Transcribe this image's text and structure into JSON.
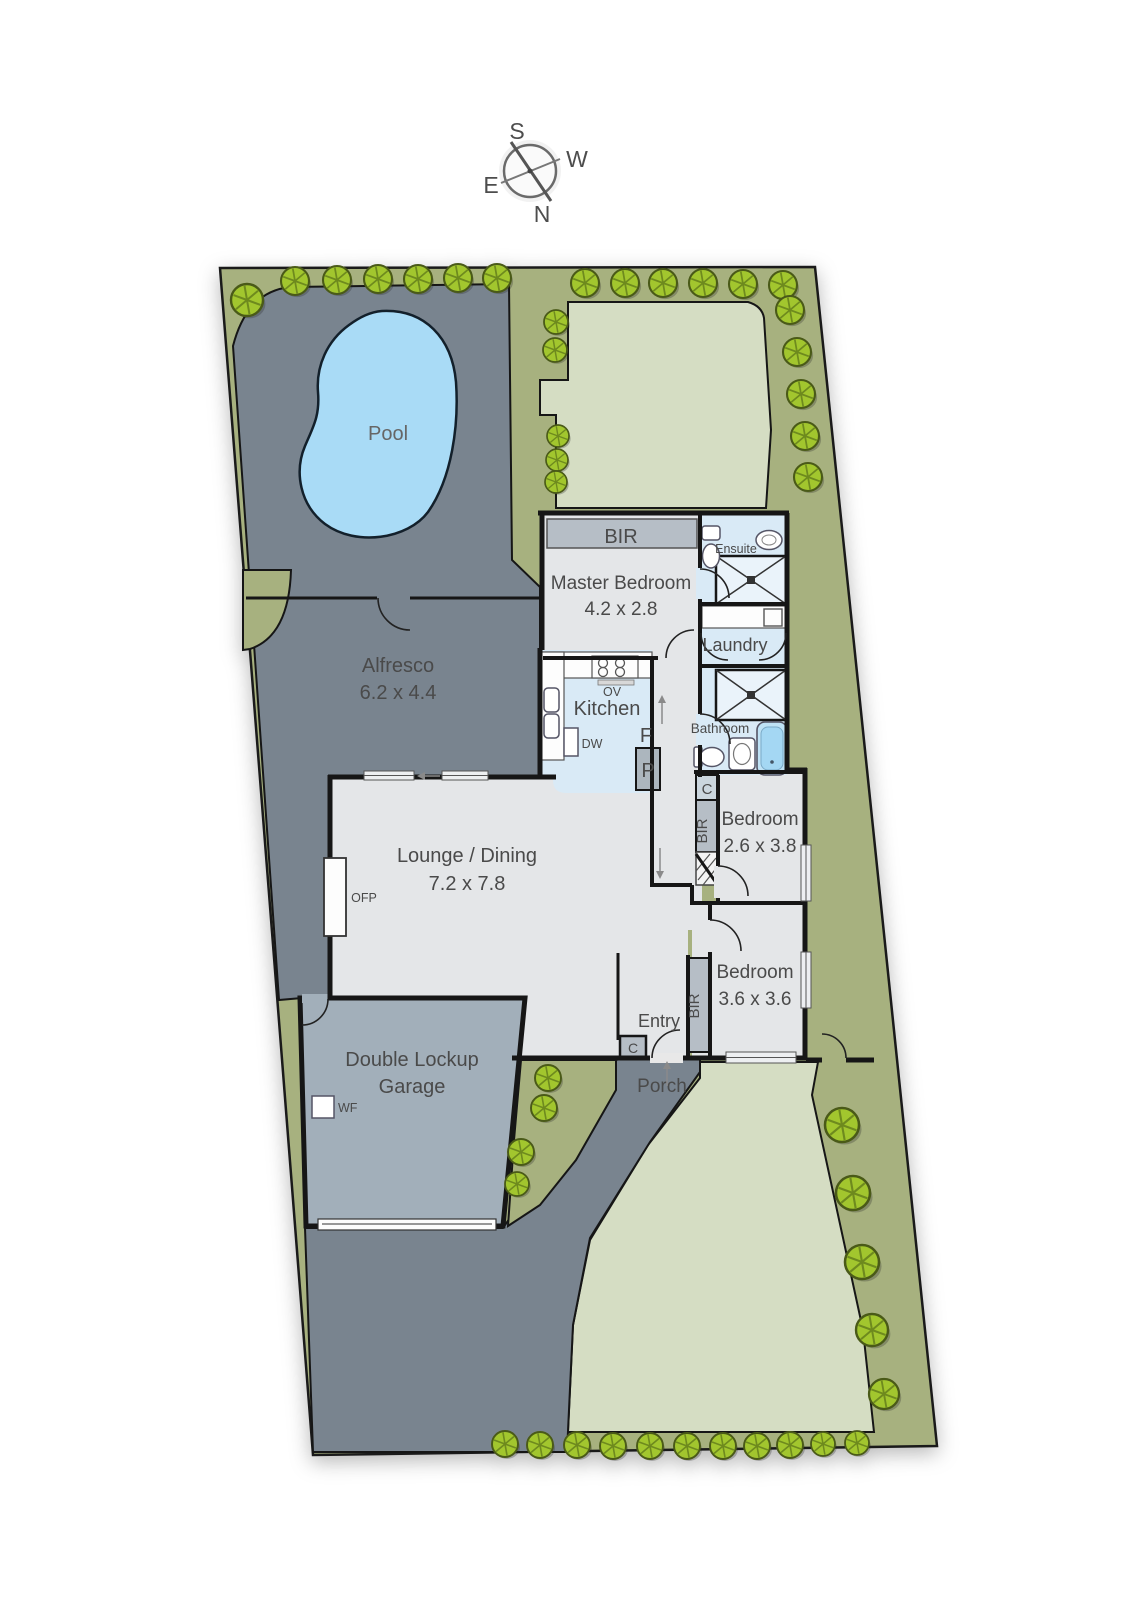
{
  "title": "Residential floor / site plan",
  "compass": {
    "north": "N",
    "south": "S",
    "east": "E",
    "west": "W"
  },
  "site": {
    "pool": {
      "label": "Pool"
    },
    "alfresco": {
      "name": "Alfresco",
      "dims": "6.2 x 4.4"
    },
    "garage": {
      "name_line1": "Double Lockup",
      "name_line2": "Garage",
      "wf": "WF"
    },
    "porch": {
      "label": "Porch"
    }
  },
  "house": {
    "master_bedroom": {
      "name": "Master Bedroom",
      "dims": "4.2 x 2.8",
      "bir": "BIR"
    },
    "ensuite": {
      "label": "Ensuite"
    },
    "laundry": {
      "label": "Laundry"
    },
    "kitchen": {
      "label": "Kitchen",
      "ov": "OV",
      "dw": "DW",
      "fridge": "F",
      "pantry": "P"
    },
    "bathroom": {
      "label": "Bathroom"
    },
    "hall": {
      "cupboard": "C"
    },
    "bedroom2": {
      "name": "Bedroom",
      "dims": "2.6 x 3.8",
      "bir": "BIR"
    },
    "bedroom3": {
      "name": "Bedroom",
      "dims": "3.6 x 3.6",
      "bir": "BIR"
    },
    "lounge": {
      "name": "Lounge / Dining",
      "dims": "7.2 x 7.8",
      "ofp": "OFP"
    },
    "entry": {
      "label": "Entry",
      "cupboard": "C"
    }
  },
  "colors": {
    "paving": "#79848F",
    "garage_floor": "#A2AFBA",
    "house_floor": "#E4E6E8",
    "wet_floor": "#D9EAF6",
    "water": "#A9DBF6",
    "lawn": "#D5DDC3",
    "garden_bed": "#A7B17F",
    "tree": "#A2C62E",
    "wall": "#161616",
    "label_text": "#4A4A4A"
  }
}
